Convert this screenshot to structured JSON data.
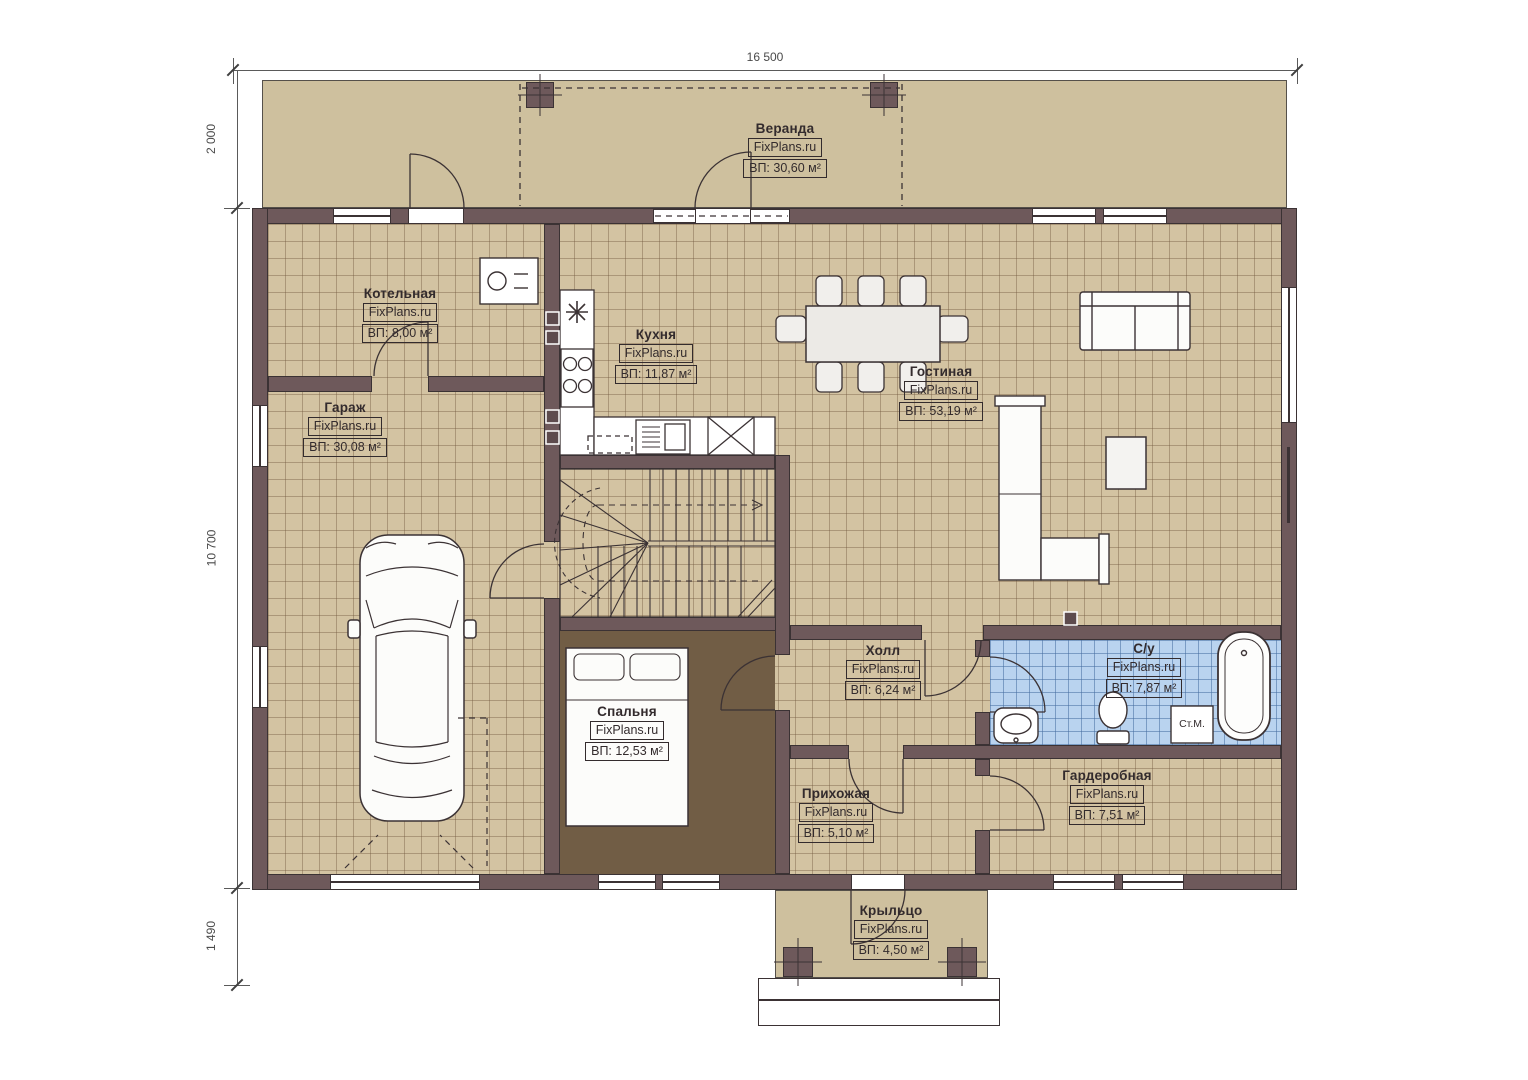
{
  "brand": "FixPlans.ru",
  "dimensions": {
    "top": "16 500",
    "left_top": "2 000",
    "left_middle": "10 700",
    "left_bottom": "1 490"
  },
  "rooms": [
    {
      "id": "veranda",
      "name": "Веранда",
      "area": "ВП: 30,60 м²"
    },
    {
      "id": "kotelnaya",
      "name": "Котельная",
      "area": "ВП: 8,00 м²"
    },
    {
      "id": "kuhnya",
      "name": "Кухня",
      "area": "ВП: 11,87 м²"
    },
    {
      "id": "gostinaya",
      "name": "Гостиная",
      "area": "ВП: 53,19 м²"
    },
    {
      "id": "garazh",
      "name": "Гараж",
      "area": "ВП: 30,08 м²"
    },
    {
      "id": "spalnya",
      "name": "Спальня",
      "area": "ВП: 12,53 м²"
    },
    {
      "id": "holl",
      "name": "Холл",
      "area": "ВП: 6,24 м²"
    },
    {
      "id": "sanuzel",
      "name": "С/у",
      "area": "ВП: 7,87 м²"
    },
    {
      "id": "prihozhaya",
      "name": "Прихожая",
      "area": "ВП: 5,10 м²"
    },
    {
      "id": "garderobnaya",
      "name": "Гардеробная",
      "area": "ВП: 7,51 м²"
    },
    {
      "id": "kryltso",
      "name": "Крыльцо",
      "area": "ВП: 4,50 м²"
    }
  ],
  "labels": {
    "washing_machine": "Ст.М."
  },
  "colors": {
    "wall": "#6e595b",
    "floor_tile": "#d3c3a2",
    "bathroom_tile": "#b9d3ef",
    "bedroom_floor": "#715d45",
    "veranda_slab": "#cec09e"
  }
}
